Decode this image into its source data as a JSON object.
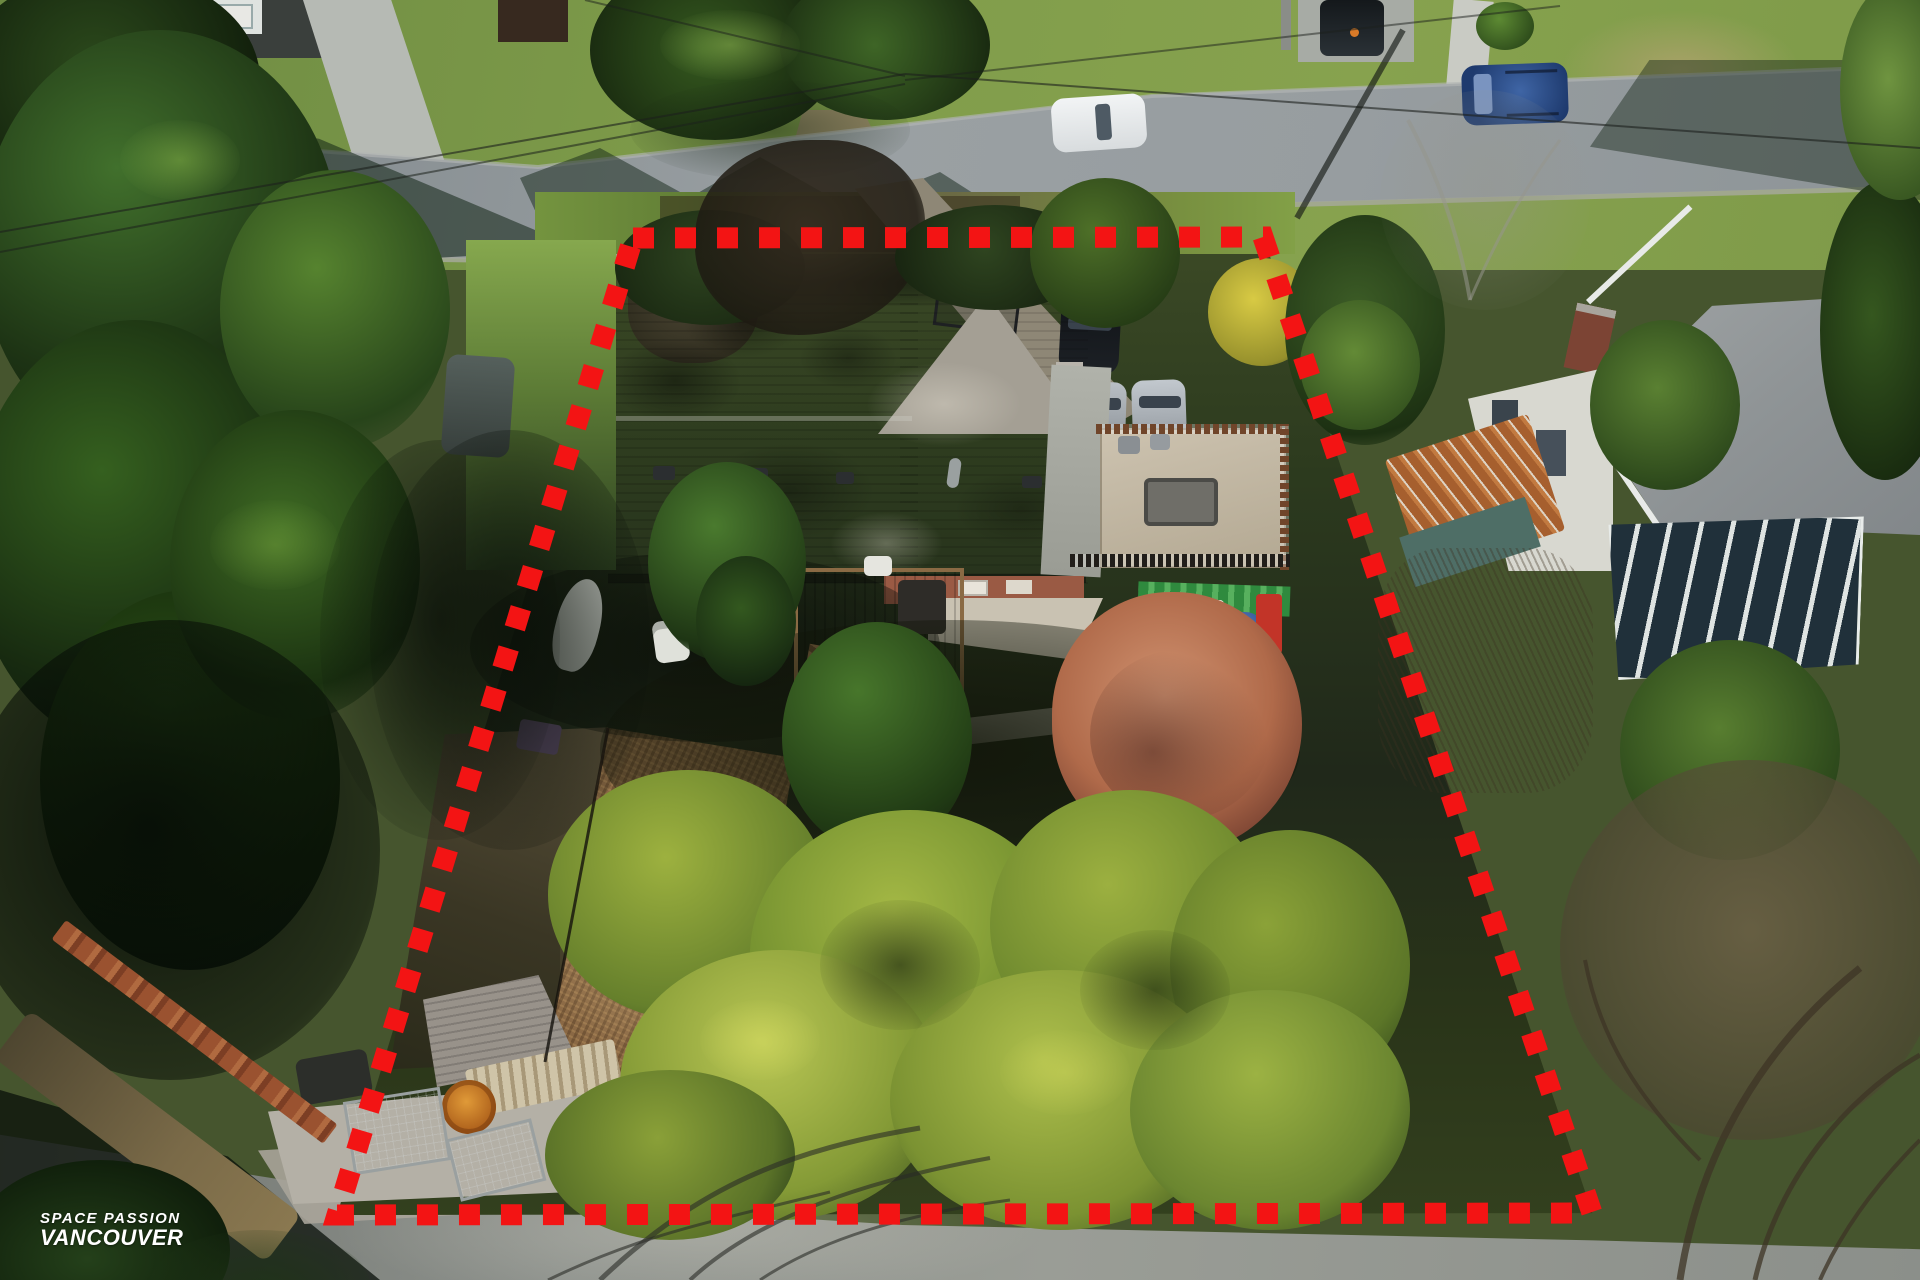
{
  "image_kind": "aerial drone photograph of a residential lot with marketing watermark",
  "watermark": {
    "line1": "SPACE PASSION",
    "line2": "VANCOUVER",
    "color": "#ffffff"
  },
  "boundary": {
    "color": "#f31414",
    "style": "dashed-square-lot-line",
    "stroke_px": 21,
    "dash_px": 21,
    "gap_px": 21,
    "points": "633,238 1263,237 1592,1213 337,1215",
    "corners": {
      "top_left": [
        633,
        238
      ],
      "top_right": [
        1263,
        237
      ],
      "bottom_right": [
        1592,
        1213
      ],
      "bottom_left": [
        337,
        1215
      ]
    }
  },
  "scene": {
    "setting": "suburban residential neighbourhood, low winter sun, bare trees and evergreens",
    "streets": {
      "top": "paved road crossing the upper frame diagonally with power lines and tree shadows",
      "bottom": "paved road along the bottom edge covered by bare-branch shadows"
    },
    "subject_property": {
      "main_house": "grey shingle gable roof, brick chimney, flat tan rooftop deck with railings over garage addition",
      "outbuilding": "large gable-roof garage/workshop, roof blanketed in fallen brown leaves",
      "carport": "white-frame carport with lumber stack, wire mesh baskets and an orange cable spool",
      "patio": "shaded patio with folded umbrella, white chairs, colourful kayak and brown wood deck with steps",
      "yard": "backyard with coral dried-leaf maple, green conifers and a broad golden cypress hedge"
    },
    "neighbors": {
      "right": "hip-roof house with brick chimney, glass sunroom and a rusty corrugated garden shed with teal walls",
      "top_left": "house and parked vehicles partially visible across the street"
    },
    "vehicles": [
      {
        "name": "white-suv",
        "color": "#e9ebec",
        "location": "parked on upper road, centre"
      },
      {
        "name": "dark-blue-suv",
        "color": "#24406f",
        "location": "parked on upper road, right"
      },
      {
        "name": "black-pickup-truck",
        "color": "#23282c",
        "location": "driveway, top right"
      },
      {
        "name": "dark-car",
        "color": "#17191d",
        "location": "subject driveway"
      },
      {
        "name": "covered-car-grey-1",
        "color": "#9ba1a7",
        "location": "subject driveway"
      },
      {
        "name": "covered-car-grey-2",
        "color": "#a7adb3",
        "location": "subject driveway"
      },
      {
        "name": "utility-trailer",
        "color": "#4a4f4d",
        "location": "left neighbour frontage"
      }
    ],
    "palette": {
      "road": "#939a9d",
      "road_shadow": "#39492f",
      "conifer_dark": "#1e3314",
      "conifer_light": "#4a7a2e",
      "golden_cypress": "#a2b545",
      "maple_coral": "#bd7a57",
      "roof_shadow": "#464c51",
      "roof_sunlit": "#a9a49a",
      "leaf_roof": "#8a6a44",
      "deck_tan": "#c6bba6",
      "lawn": "#7f9c4a",
      "soil_shadow": "#1f2816"
    }
  }
}
